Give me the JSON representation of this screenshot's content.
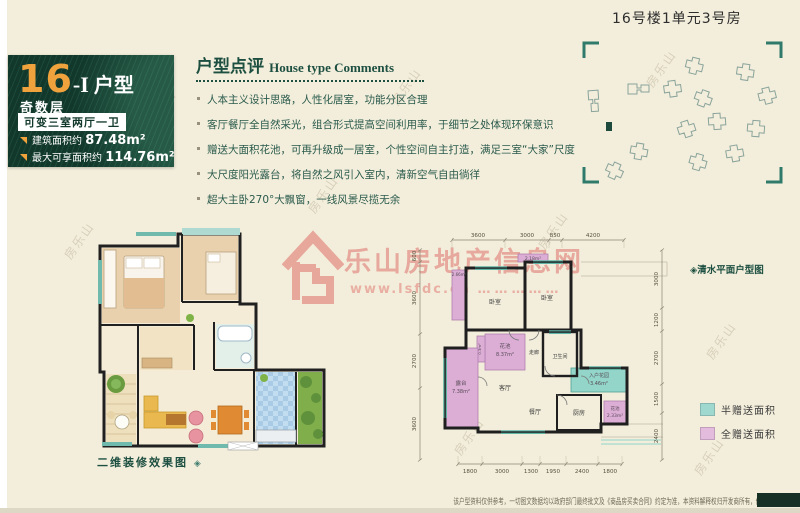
{
  "colors": {
    "page_bg": "#f3eedb",
    "panel_green": "#12382c",
    "accent_orange": "#f0a23c",
    "heading_green": "#1d4f41",
    "wall_black": "#1f1f1f",
    "window_teal": "#5fb4a6",
    "half_gift_teal": "#9fd8cf",
    "full_gift_pink": "#e3bbdd",
    "watermark_pink": "#e07c74"
  },
  "unit_panel": {
    "number": "16",
    "suffix": "-I",
    "type_word": "户型",
    "floor_label": "奇数层",
    "variant_label": "可变三室两厅一卫",
    "area1_label": "建筑面积约",
    "area1_value": "87.48m²",
    "area2_label": "最大可享面积约",
    "area2_value": "114.76m²"
  },
  "comments": {
    "title_cn": "户型点评",
    "title_en": "House type Comments",
    "items": [
      "人本主义设计思路，人性化居室，功能分区合理",
      "客厅餐厅全自然采光，组合形式提高空间利用率，于细节之处体现环保意识",
      "赠送大面积花池，可再升级成一居室，个性空间自主打造，满足三室“大家”尺度",
      "大尺度阳光露台，将自然之风引入室内，清新空气自由徜徉",
      "超大主卧270°大飘窗，一线风景尽揽无余"
    ]
  },
  "site_plan": {
    "title": "16号楼1单元3号房"
  },
  "watermark": {
    "logo_text": "S",
    "name": "乐山房地产信息网",
    "url": "www.lsfdc.cn",
    "dots": "……………",
    "tile_text": "房乐山"
  },
  "decor_plan": {
    "caption": "二维装修效果图",
    "caption_icon": "◈"
  },
  "floor_plan": {
    "note": "◈清水平面户型图",
    "rooms": {
      "bedroom1": "卧室",
      "bedroom2": "卧室",
      "living": "客厅",
      "dining": "餐厅",
      "bathroom": "卫生间",
      "corridor": "走廊",
      "kitchen": "厨房"
    },
    "areas": {
      "flower_large_name": "花池",
      "flower_large_area": "8.37m²",
      "terrace_name": "露台",
      "terrace_area": "7.38m²",
      "entry_garden_name": "入户花园",
      "entry_garden_area": "3.46m²",
      "flower_small_name": "花池",
      "flower_small_area": "2.33m²",
      "strip_left": "2.66m²",
      "strip_top": "2.18m²",
      "strip_tiny": "0.3m²"
    },
    "dims_top": [
      "3600",
      "3000",
      "850",
      "4200"
    ],
    "dims_bottom": [
      "1800",
      "3000",
      "1300",
      "1950",
      "2400",
      "1800"
    ],
    "dims_left": [
      "600",
      "3600",
      "2700",
      "3600"
    ],
    "dims_right": [
      "3000",
      "1200",
      "2700",
      "1500",
      "2400"
    ],
    "legend": [
      {
        "label": "半赠送面积",
        "color": "#9fd8cf"
      },
      {
        "label": "全赠送面积",
        "color": "#e3bbdd"
      }
    ]
  },
  "footer": {
    "disclaimer": "该户型资料仅供参考，一切图文数据均以政府部门最终批文及《商品房买卖合同》约定为准，本资料解释权归开发商所有，修改恕不另行通知"
  }
}
